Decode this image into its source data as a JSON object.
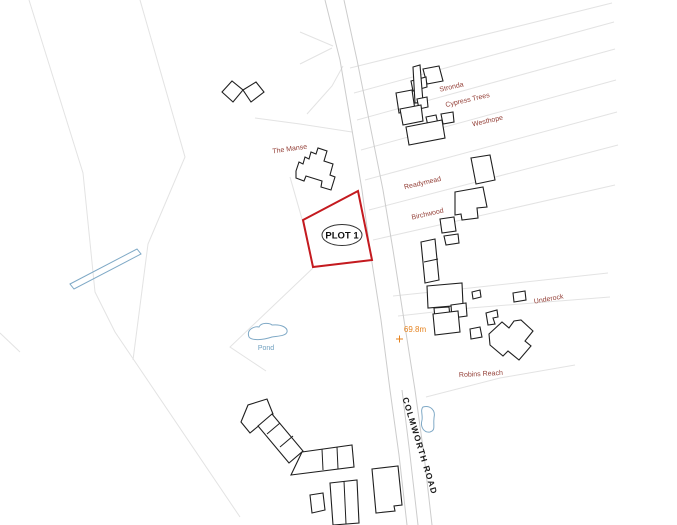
{
  "plot": {
    "label": "PLOT 1"
  },
  "road": {
    "name": "COLMWORTH ROAD"
  },
  "water": {
    "pond_label": "Pond"
  },
  "spot_height": {
    "label": "69.8m"
  },
  "properties": {
    "the_manse": "The Manse",
    "stronda": "Stronda",
    "cypress_trees": "Cypress Trees",
    "westhope": "Westhope",
    "readymead": "Readymead",
    "birchwood": "Birchwood",
    "underock": "Underock",
    "robins_reach": "Robins Reach"
  },
  "colors": {
    "plot_outline": "#c41a1f",
    "property_label": "#944038",
    "water": "#7fa9c6",
    "spot_height": "#e5821e",
    "building_outline": "#1f1f1f",
    "road_edge": "#cccccc",
    "field_boundary": "#e3e3e3",
    "background": "#ffffff"
  }
}
